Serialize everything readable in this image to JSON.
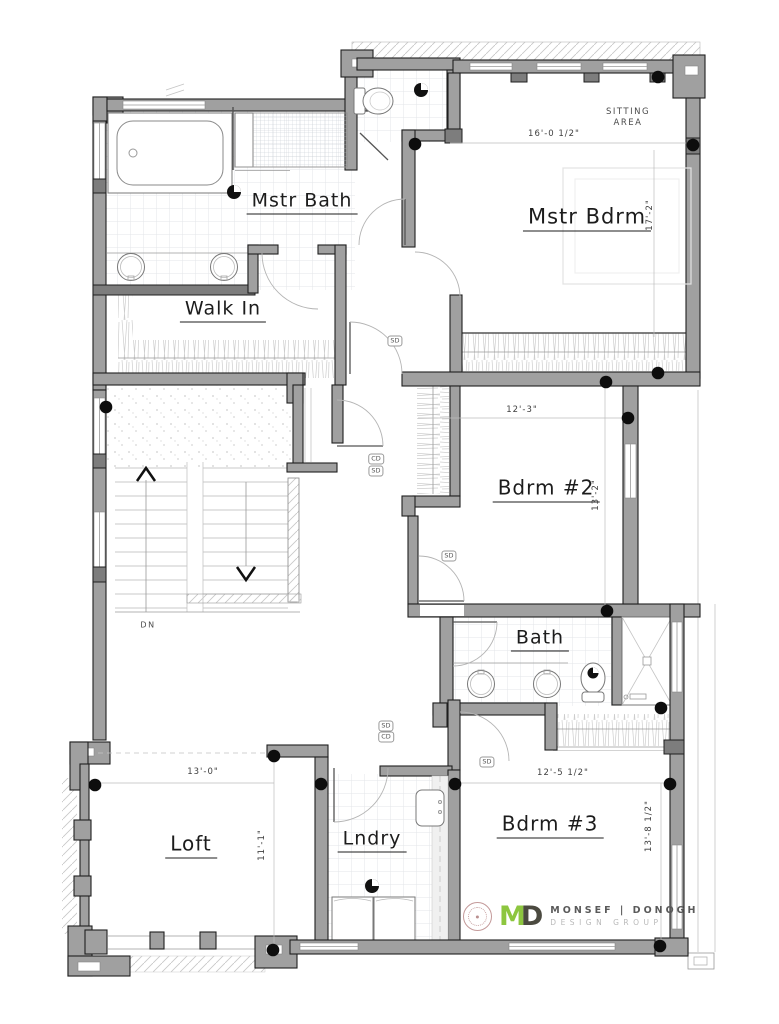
{
  "plan": {
    "rooms": [
      {
        "label": "Mstr Bath"
      },
      {
        "label": "Mstr Bdrm"
      },
      {
        "label": "Walk In"
      },
      {
        "label": "Bdrm #2"
      },
      {
        "label": "Bath"
      },
      {
        "label": "Loft"
      },
      {
        "label": "Lndry"
      },
      {
        "label": "Bdrm #3"
      }
    ],
    "annotations": {
      "sitting1": "SITTING",
      "sitting2": "AREA",
      "down": "DN"
    },
    "dims": {
      "mstr_w": "16'-0 1/2\"",
      "mstr_d": "17'-2\"",
      "b2_w": "12'-3\"",
      "b2_d": "13'-2\"",
      "loft_w": "13'-0\"",
      "loft_d": "11'-1\"",
      "b3_w": "12'-5 1/2\"",
      "b3_d": "13'-8 1/2\""
    },
    "detectors": [
      {
        "t": "SD"
      },
      {
        "t": "CD"
      },
      {
        "t": "SD"
      },
      {
        "t": "SD"
      },
      {
        "t": "SD"
      },
      {
        "t": "CD"
      },
      {
        "t": "SD"
      }
    ]
  },
  "logo": {
    "m": "M",
    "d": "D",
    "name": "MONSEF | DONOGH",
    "tagline": "DESIGN GROUP",
    "green": "#8dc63f",
    "dark": "#4b4a40",
    "stamp_color": "#c49a9a"
  }
}
